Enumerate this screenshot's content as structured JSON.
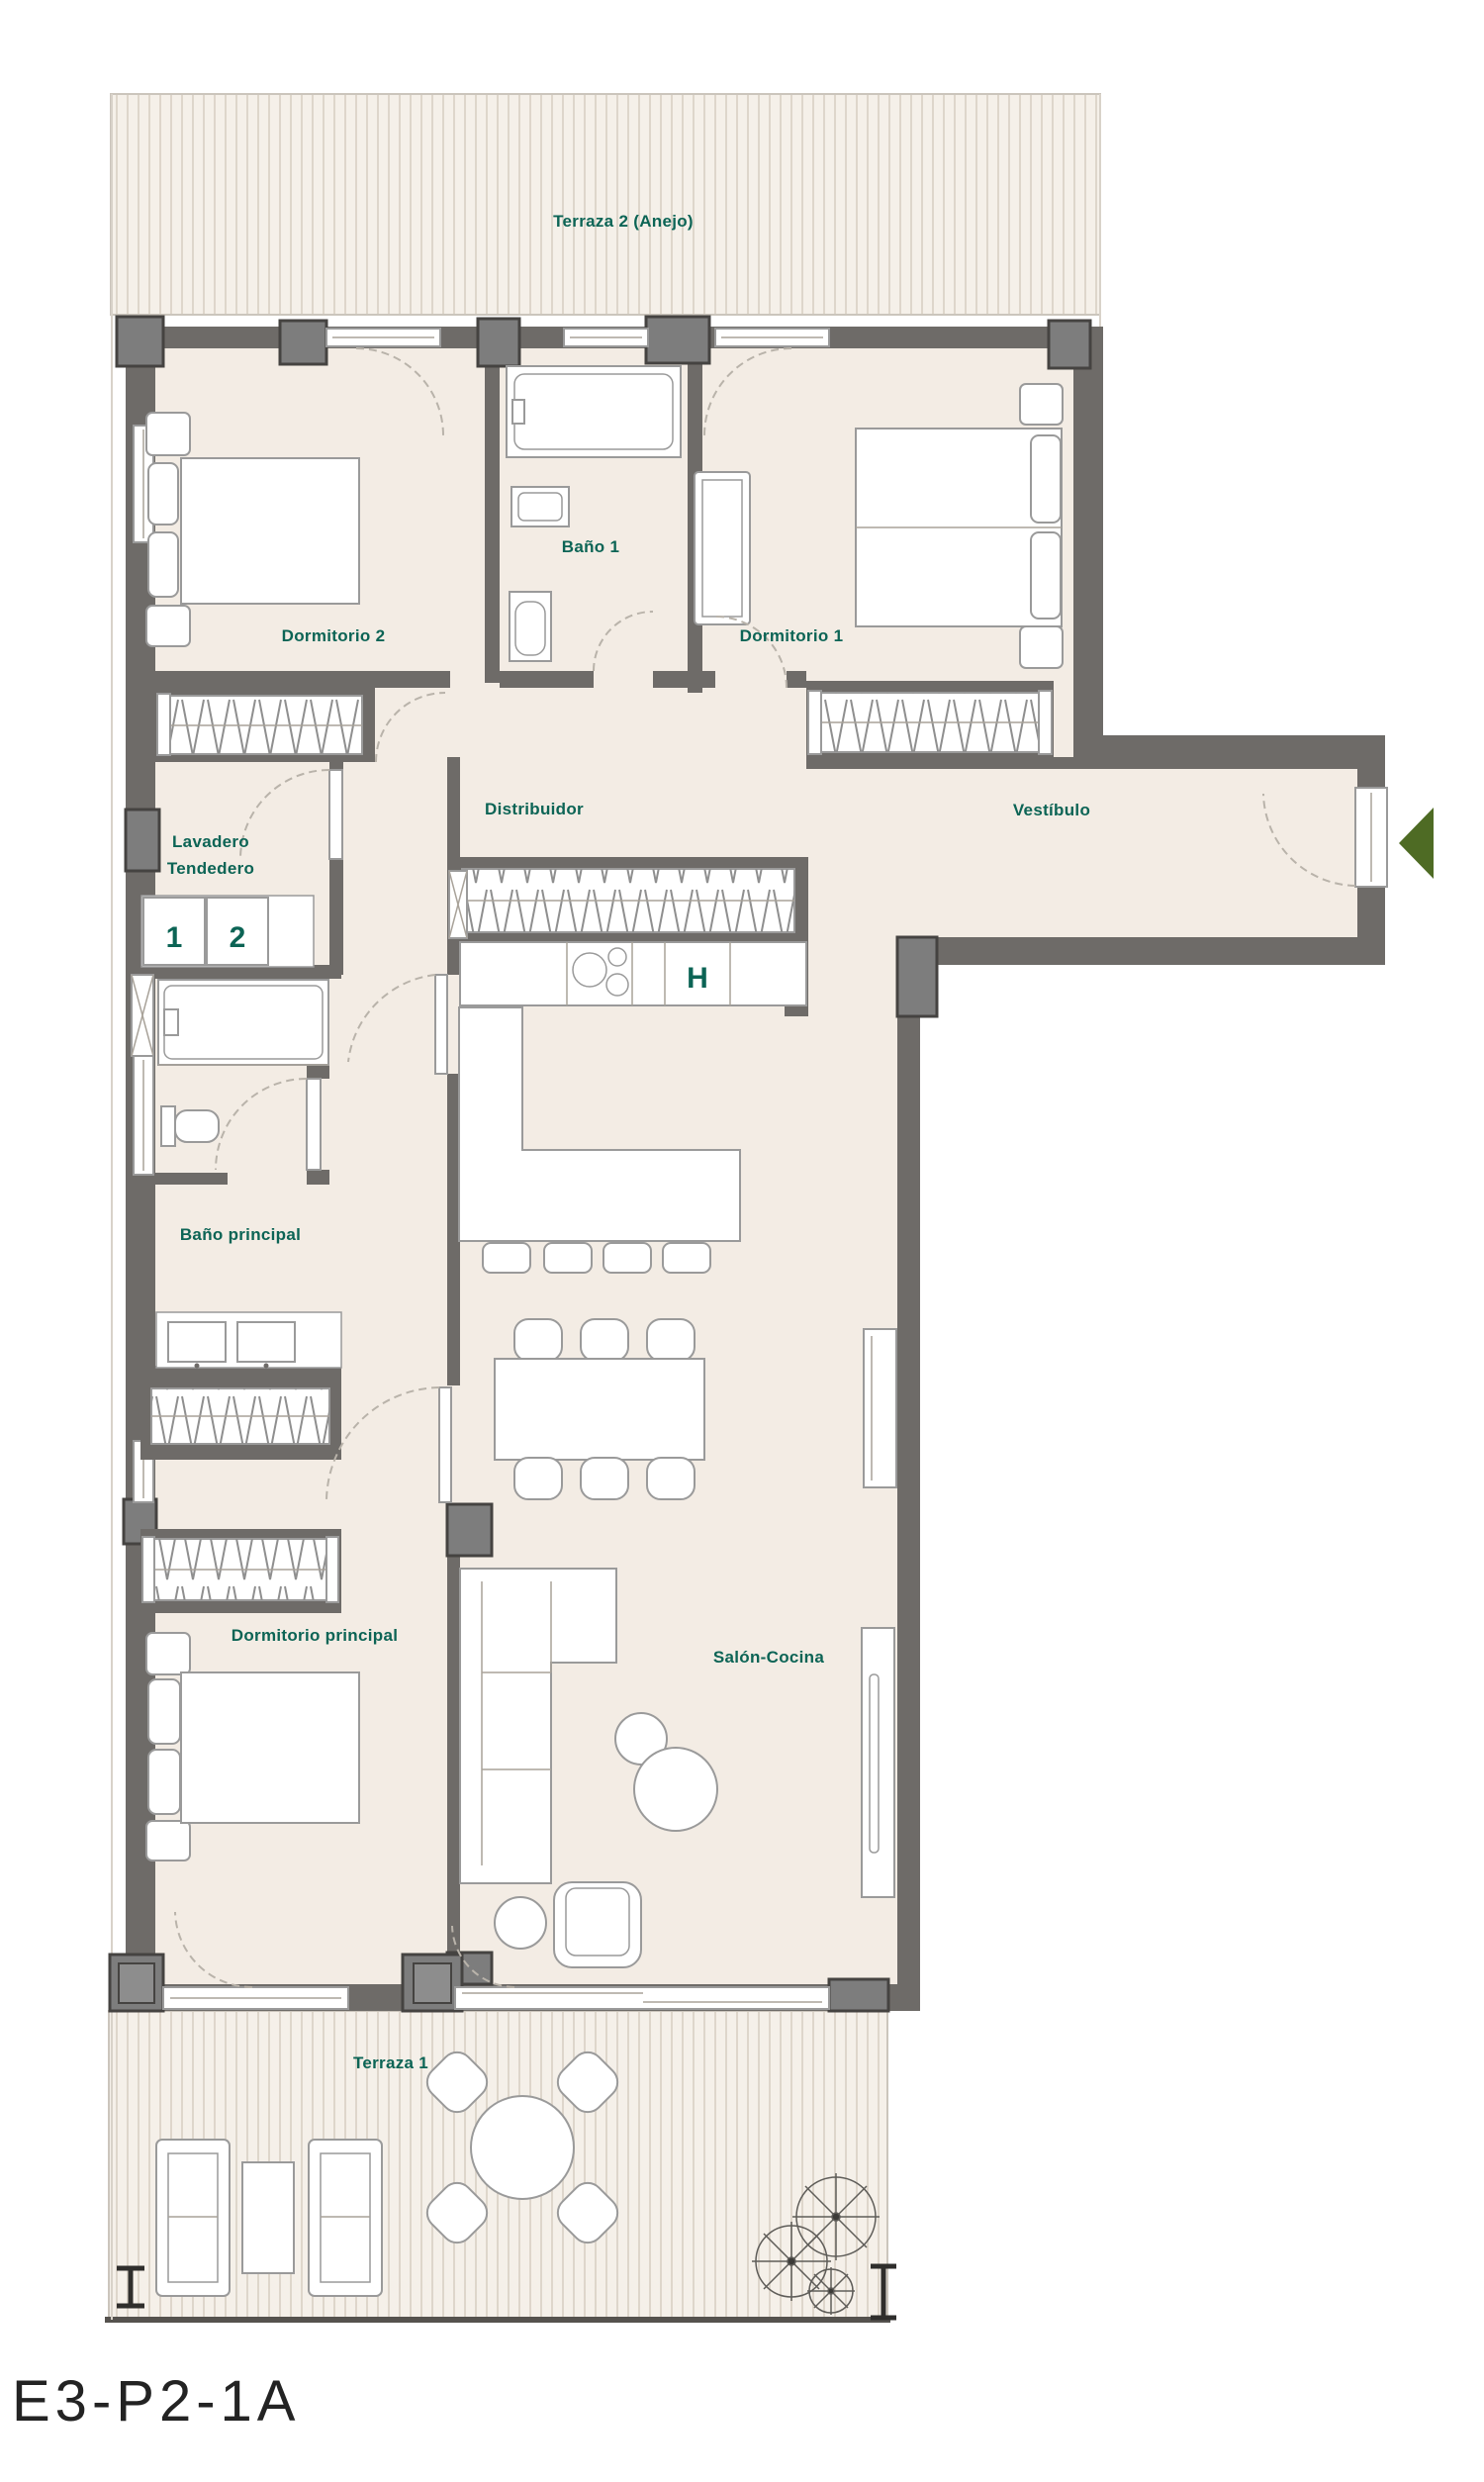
{
  "meta": {
    "plan_code": "E3-P2-1A"
  },
  "colors": {
    "floor": "#f3ece4",
    "terrace": "#f5f0e9",
    "terrace-stripe": "#ded6cb",
    "wall": "#6e6b68",
    "wall-dark": "#454341",
    "block": "#7d7d7d",
    "line": "#9a9a9a",
    "label": "#0c6455",
    "accent-green": "#4e6b24",
    "code": "#232323"
  },
  "rooms": {
    "terraza2": {
      "label": "Terraza 2 (Anejo)"
    },
    "dormitorio2": {
      "label": "Dormitorio 2"
    },
    "bano1": {
      "label": "Baño 1"
    },
    "dormitorio1": {
      "label": "Dormitorio 1"
    },
    "distribuidor": {
      "label": "Distribuidor"
    },
    "vestibulo": {
      "label": "Vestíbulo"
    },
    "lavadero": {
      "label_line1": "Lavadero",
      "label_line2": "Tendedero"
    },
    "bano_principal": {
      "label": "Baño principal"
    },
    "dormitorio_principal": {
      "label": "Dormitorio principal"
    },
    "salon_cocina": {
      "label": "Salón-Cocina"
    },
    "terraza1": {
      "label": "Terraza 1"
    }
  },
  "markers": {
    "washer": "1",
    "dryer": "2",
    "kitchen_column": "H"
  }
}
